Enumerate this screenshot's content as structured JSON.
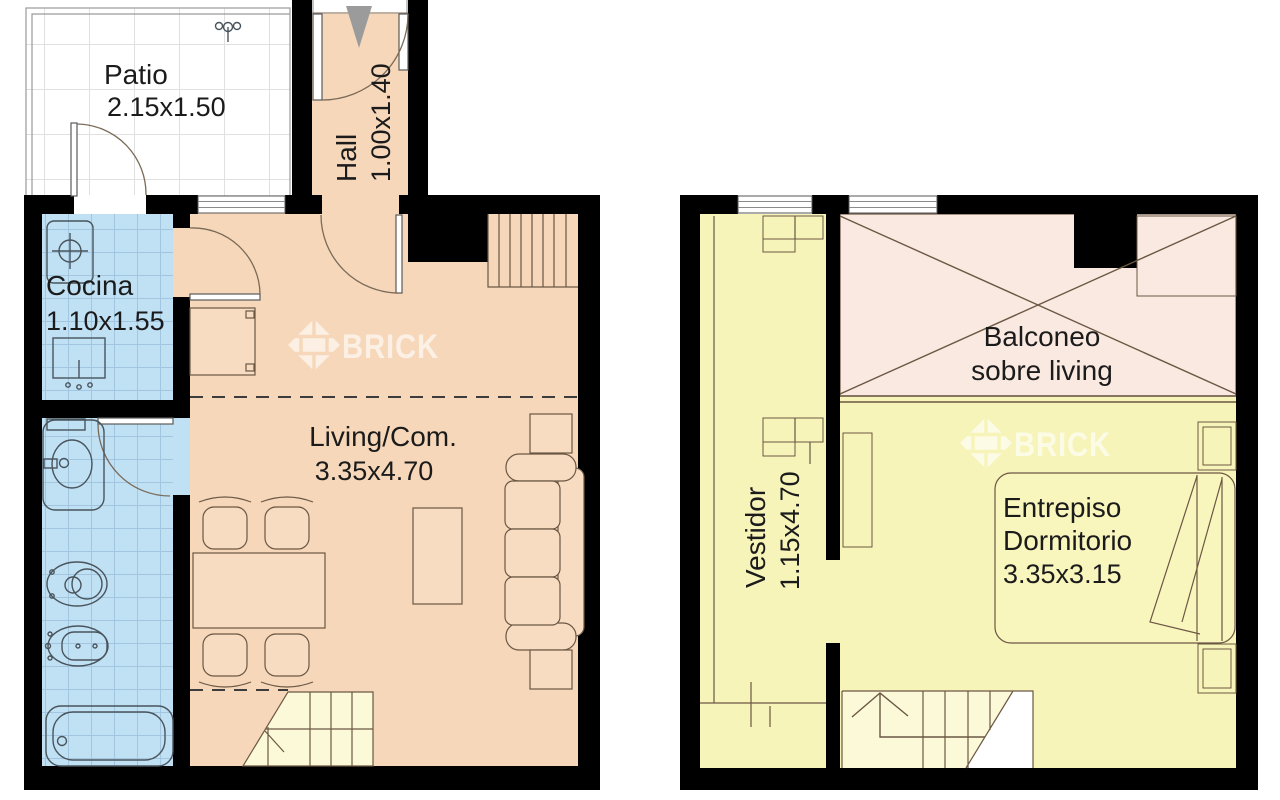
{
  "watermark": {
    "brand": "BRICK"
  },
  "lower_plan": {
    "patio": {
      "name": "Patio",
      "dims": "2.15x1.50"
    },
    "hall": {
      "name": "Hall",
      "dims": "1.00x1.40"
    },
    "cocina": {
      "name": "Cocina",
      "dims": "1.10x1.55"
    },
    "living": {
      "name": "Living/Com.",
      "dims": "3.35x4.70"
    }
  },
  "upper_plan": {
    "balconeo": {
      "line1": "Balconeo",
      "line2": "sobre living"
    },
    "vestidor": {
      "name": "Vestidor",
      "dims": "1.15x4.70"
    },
    "dormitorio": {
      "line1": "Entrepiso",
      "line2": "Dormitorio",
      "dims": "3.35x3.15"
    }
  },
  "colors": {
    "wall": "#000000",
    "floor-warm": "#f6d7ba",
    "floor-wet": "#c0e0f4",
    "floor-upper": "#f7f4ba",
    "void-pink": "#f9e9e0",
    "stair-pale": "#fbf9d8",
    "text": "#1b1b1b",
    "line": "#6b5743",
    "arrow": "#9b9b9b"
  }
}
